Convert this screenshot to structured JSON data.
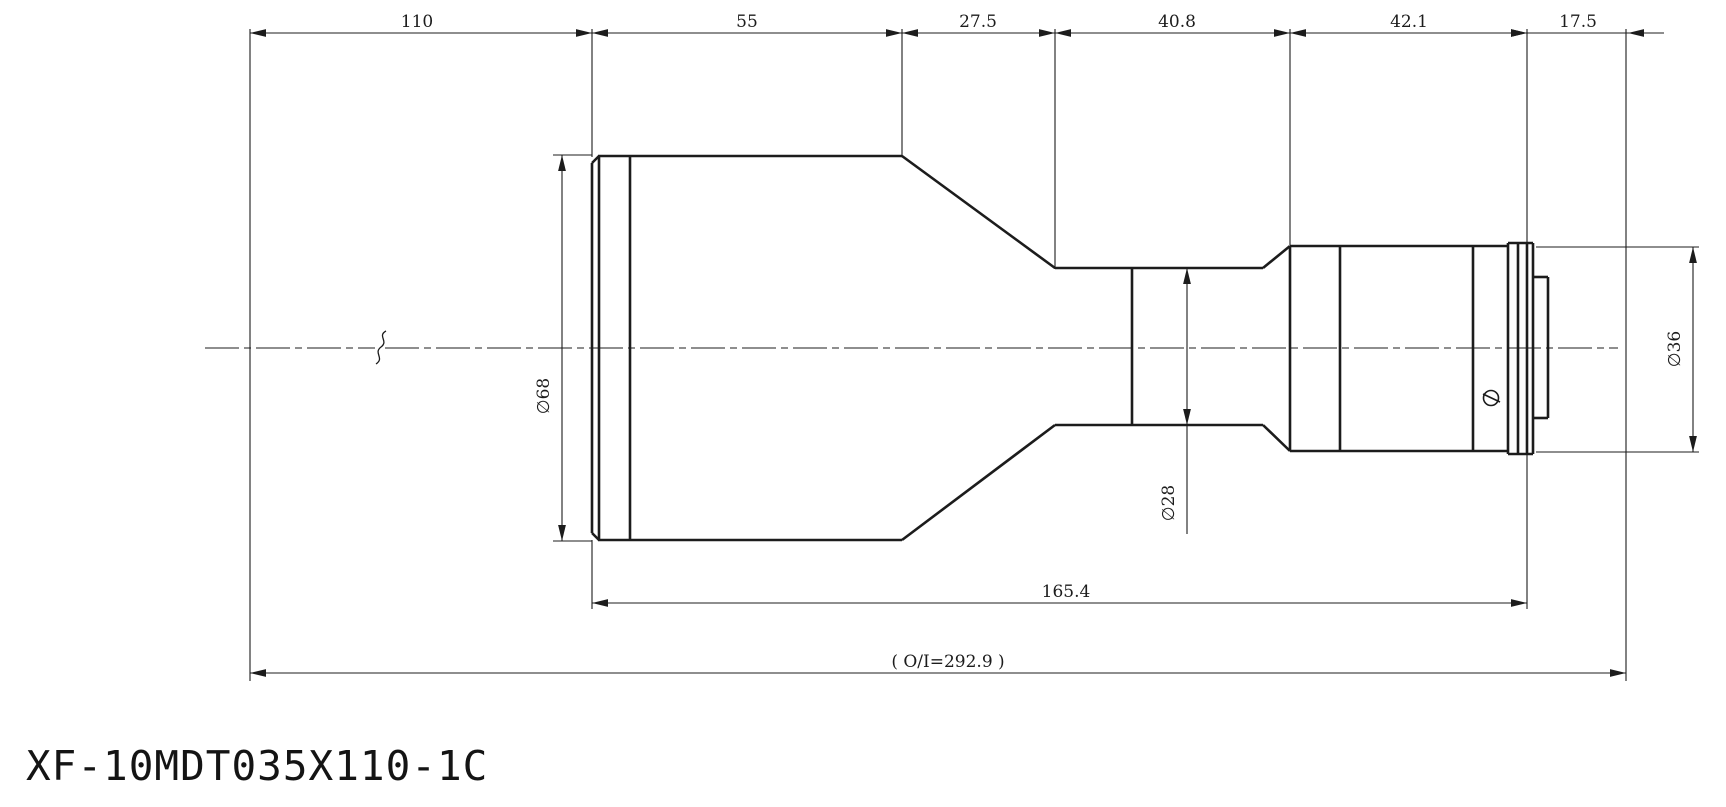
{
  "title": {
    "part_number": "XF-10MDT035X110-1C"
  },
  "drawing": {
    "canvas": {
      "w": 1726,
      "h": 807,
      "bg": "#ffffff",
      "line_color": "#1c1c1c",
      "dim_font": 17
    },
    "linear_dimensions": [
      {
        "name": "110",
        "label": "110",
        "axis": "x",
        "line": 33,
        "from": 250,
        "to": 592,
        "label_x": 417,
        "label_y": 27,
        "arrows": "in"
      },
      {
        "name": "55",
        "label": "55",
        "axis": "x",
        "line": 33,
        "from": 592,
        "to": 902,
        "label_x": 747,
        "label_y": 27,
        "arrows": "in"
      },
      {
        "name": "27-5",
        "label": "27.5",
        "axis": "x",
        "line": 33,
        "from": 902,
        "to": 1055,
        "label_x": 978,
        "label_y": 27,
        "arrows": "in"
      },
      {
        "name": "40-8",
        "label": "40.8",
        "axis": "x",
        "line": 33,
        "from": 1055,
        "to": 1290,
        "label_x": 1177,
        "label_y": 27,
        "arrows": "in"
      },
      {
        "name": "42-1",
        "label": "42.1",
        "axis": "x",
        "line": 33,
        "from": 1290,
        "to": 1527,
        "label_x": 1409,
        "label_y": 27,
        "arrows": "in"
      },
      {
        "name": "17-5",
        "label": "17.5",
        "axis": "x",
        "line": 33,
        "from": 1527,
        "to": 1628,
        "label_x": 1578,
        "label_y": 27,
        "arrows": "out",
        "tail": 36
      },
      {
        "name": "165-4",
        "label": "165.4",
        "axis": "x",
        "line": 603,
        "from": 592,
        "to": 1527,
        "label_x": 1066,
        "label_y": 597,
        "arrows": "in"
      },
      {
        "name": "o-i",
        "label": "( O/I=292.9 )",
        "axis": "x",
        "line": 673,
        "from": 250,
        "to": 1626,
        "label_x": 948,
        "label_y": 667,
        "arrows": "in"
      },
      {
        "name": "d68",
        "label": "∅68",
        "axis": "y",
        "line": 562,
        "from": 155,
        "to": 541,
        "label_x": 549,
        "label_y": 396,
        "arrows": "in"
      },
      {
        "name": "d28",
        "label": "∅28",
        "axis": "y",
        "line": 1187,
        "from": 268,
        "to": 425,
        "label_x": 1174,
        "label_y": 503,
        "arrows": "in",
        "tail_to": 534
      },
      {
        "name": "d36",
        "label": "∅36",
        "axis": "y",
        "line": 1693,
        "from": 247,
        "to": 452,
        "label_x": 1680,
        "label_y": 349,
        "arrows": "in"
      }
    ],
    "extension_lines": [
      [
        250,
        29,
        250,
        681
      ],
      [
        592,
        29,
        592,
        157
      ],
      [
        592,
        540,
        592,
        609
      ],
      [
        902,
        29,
        902,
        157
      ],
      [
        1055,
        29,
        1055,
        269
      ],
      [
        1290,
        29,
        1290,
        245
      ],
      [
        1527,
        29,
        1527,
        609
      ],
      [
        1626,
        29,
        1626,
        681
      ],
      [
        553,
        155,
        592,
        155
      ],
      [
        553,
        541,
        592,
        541
      ],
      [
        1536,
        247,
        1699,
        247
      ],
      [
        1536,
        452,
        1699,
        452
      ]
    ],
    "outline": [
      [
        592,
        163,
        592,
        533
      ],
      [
        592,
        163,
        599,
        156
      ],
      [
        592,
        533,
        599,
        540
      ],
      [
        599,
        156,
        599,
        540
      ],
      [
        630,
        156,
        630,
        540
      ],
      [
        598,
        156,
        902,
        156
      ],
      [
        598,
        540,
        902,
        540
      ],
      [
        902,
        156,
        1055,
        268
      ],
      [
        902,
        540,
        1055,
        425
      ],
      [
        1055,
        268,
        1263,
        268
      ],
      [
        1055,
        425,
        1263,
        425
      ],
      [
        1132,
        268,
        1132,
        425
      ],
      [
        1263,
        268,
        1290,
        246
      ],
      [
        1263,
        425,
        1290,
        451
      ],
      [
        1290,
        246,
        1290,
        451
      ],
      [
        1290,
        246,
        1508,
        246
      ],
      [
        1290,
        451,
        1508,
        451
      ],
      [
        1340,
        246,
        1340,
        451
      ],
      [
        1473,
        246,
        1473,
        451
      ],
      [
        1508,
        243,
        1508,
        454
      ],
      [
        1518,
        243,
        1518,
        454
      ],
      [
        1527,
        243,
        1527,
        454
      ],
      [
        1533,
        243,
        1533,
        454
      ],
      [
        1508,
        243,
        1533,
        243
      ],
      [
        1508,
        454,
        1533,
        454
      ],
      [
        1533,
        277,
        1548,
        277
      ],
      [
        1533,
        418,
        1548,
        418
      ],
      [
        1548,
        277,
        1548,
        418
      ]
    ],
    "centerline": {
      "segments": [
        [
          205,
          348,
          375,
          348
        ],
        [
          385,
          348,
          1618,
          348
        ]
      ],
      "dash": "34 5 7 5",
      "break_path": "M386,331 c-9,5 3,10 -5,16 c-8,6 4,11 -5,17"
    },
    "set_screw": {
      "cx": 1491,
      "cy": 398,
      "r": 7.5,
      "slot": [
        1483,
        394,
        1500,
        402
      ]
    }
  }
}
